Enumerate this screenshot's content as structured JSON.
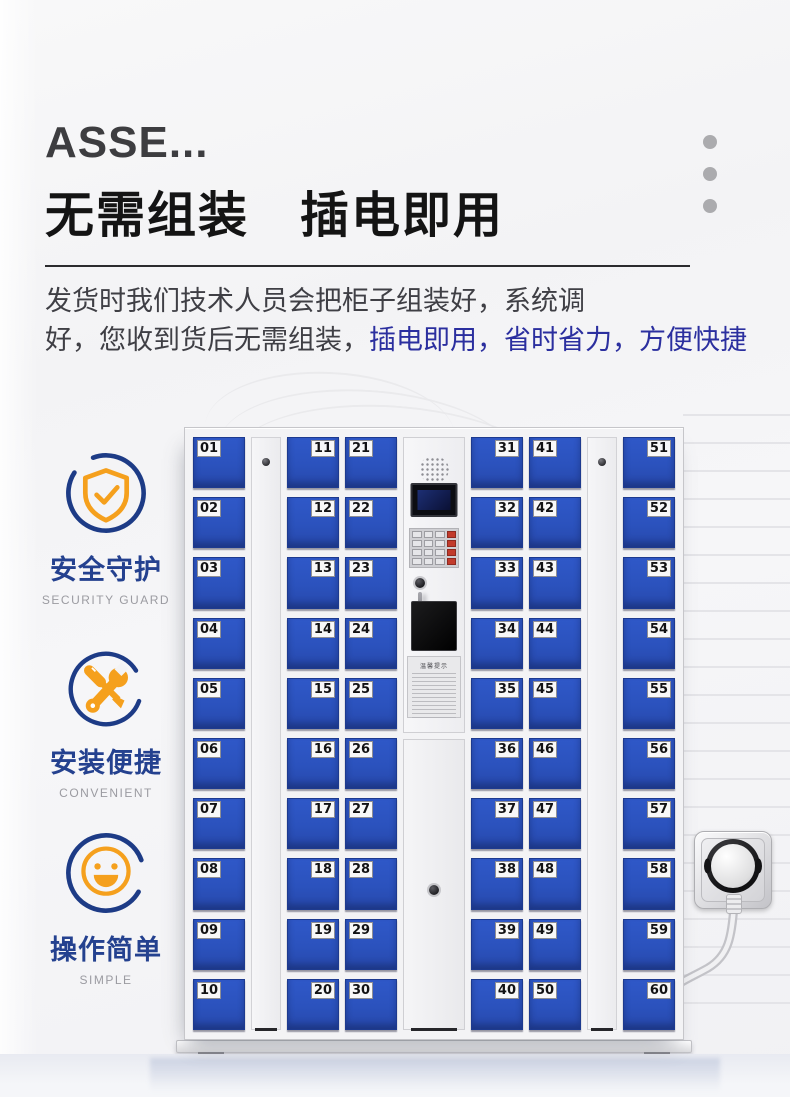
{
  "header": {
    "brand_title": "ASSE...",
    "main_title": "无需组装　插电即用",
    "description_line1": "发货时我们技术人员会把柜子组装好，系统调",
    "description_line2_normal": "好，您收到货后无需组装，",
    "description_line2_highlight": "插电即用，省时省力，方便快捷"
  },
  "features": [
    {
      "icon": "shield-check-icon",
      "label_cn": "安全守护",
      "label_en": "SECURITY GUARD"
    },
    {
      "icon": "tools-icon",
      "label_cn": "安装便捷",
      "label_en": "CONVENIENT"
    },
    {
      "icon": "smiley-icon",
      "label_cn": "操作简单",
      "label_en": "SIMPLE"
    }
  ],
  "locker": {
    "columns": [
      {
        "label_side": "left",
        "doors": [
          "01",
          "02",
          "03",
          "04",
          "05",
          "06",
          "07",
          "08",
          "09",
          "10"
        ]
      },
      {
        "label_side": "right",
        "doors": [
          "11",
          "12",
          "13",
          "14",
          "15",
          "16",
          "17",
          "18",
          "19",
          "20"
        ]
      },
      {
        "label_side": "left",
        "doors": [
          "21",
          "22",
          "23",
          "24",
          "25",
          "26",
          "27",
          "28",
          "29",
          "30"
        ]
      },
      {
        "label_side": "right",
        "doors": [
          "31",
          "32",
          "33",
          "34",
          "35",
          "36",
          "37",
          "38",
          "39",
          "40"
        ]
      },
      {
        "label_side": "left",
        "doors": [
          "41",
          "42",
          "43",
          "44",
          "45",
          "46",
          "47",
          "48",
          "49",
          "50"
        ]
      },
      {
        "label_side": "right",
        "doors": [
          "51",
          "52",
          "53",
          "54",
          "55",
          "56",
          "57",
          "58",
          "59",
          "60"
        ]
      }
    ],
    "control_panel": {
      "sticker_title": "温馨提示"
    }
  },
  "colors": {
    "door_blue": "#2b52bd",
    "accent_blue_text": "#2b2f9f",
    "feature_blue": "#24418f",
    "icon_orange": "#f5a01d",
    "ring_blue": "#1d3b86"
  }
}
